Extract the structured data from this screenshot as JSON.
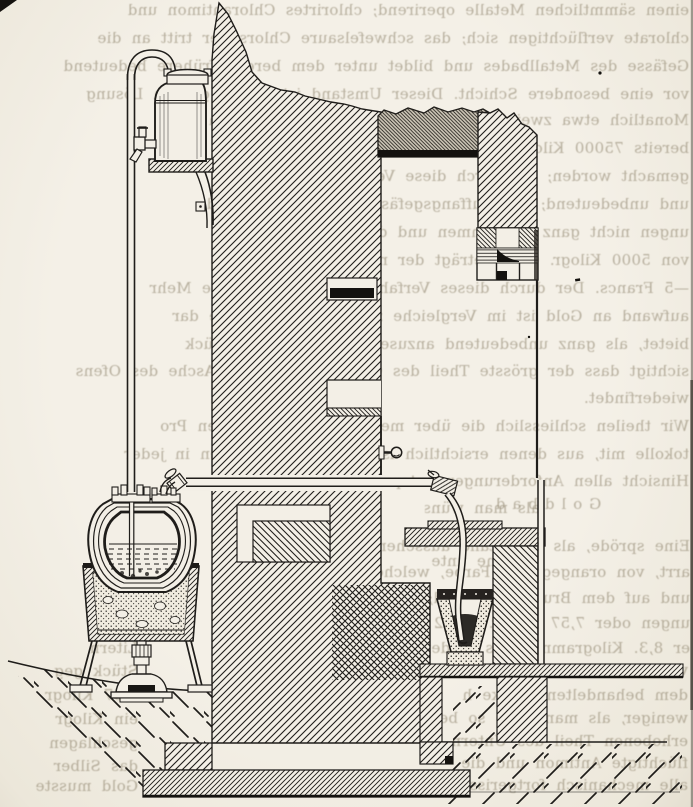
{
  "page": {
    "paper_color": "#f3efe6",
    "ink_color": "#1f1d1a",
    "ghost_ink_color": "#867b64",
    "lintel_gray": "#ccc5b6"
  },
  "ghost_text": {
    "lines": [
      {
        "text": "einen sämmtlichen Metalle operirend; chlorirtes Chlorantimon und",
        "x": 5,
        "y": 2,
        "w": 684
      },
      {
        "text": "chlorate verflüchtigen sich; das schwefelsaure Chlorsilber tritt an die",
        "x": 5,
        "y": 30,
        "w": 684
      },
      {
        "text": "Gefässe des Metallbades und bildet unter dem bereits frühere bedeutend",
        "x": 5,
        "y": 58,
        "w": 684
      },
      {
        "text": "vor eine besondere Schicht. Dieser Umstand ist in der ganzen Lösung",
        "x": 5,
        "y": 86,
        "w": 684
      },
      {
        "text": "Monatlich etwa zwei Drittel der in den Oefen derselben sind",
        "x": 5,
        "y": 112,
        "w": 684
      },
      {
        "text": "bereits 75000 Kilogr. Gold mit dem Feingehalte lange",
        "x": 5,
        "y": 140,
        "w": 684
      },
      {
        "text": "gemacht worden; die durch diese Verfahren gegeben",
        "x": 5,
        "y": 168,
        "w": 684
      },
      {
        "text": "und unbedeutend; das Auffangsgefäss des Apparates bed",
        "x": 5,
        "y": 196,
        "w": 684
      },
      {
        "text": "ungen nicht ganz vollkommen und die zur Reinigung",
        "x": 5,
        "y": 224,
        "w": 684
      },
      {
        "text": "von 5000 Kilogr. Gold beträgt der nicht mehr als",
        "x": 5,
        "y": 252,
        "w": 684
      },
      {
        "text": "—5 Francs. Der durch dieses Verfahren bedingte geringe Mehr",
        "x": 5,
        "y": 280,
        "w": 684
      },
      {
        "text": "aufwand an Gold ist im Vergleiche zu dem die derselbe dar",
        "x": 5,
        "y": 308,
        "w": 684
      },
      {
        "text": "bietet, als ganz unbedeutend anzusehen, wenn man berück",
        "x": 5,
        "y": 336,
        "w": 684
      },
      {
        "text": "sichtigt dass der grösste Theil des Goldes sich in der Asche des Ofens",
        "x": 5,
        "y": 363,
        "w": 684
      },
      {
        "text": "wiederfindet.",
        "x": 5,
        "y": 390,
        "w": 684
      },
      {
        "text": "Wir theilen schliesslich die über mehrere Jahre geführten Pro",
        "x": 5,
        "y": 418,
        "w": 684
      },
      {
        "text": "tokolle mit, aus denen ersichtlich ist, dass das Verfahren in jeder",
        "x": 5,
        "y": 446,
        "w": 684
      },
      {
        "text": "Hinsicht allen Anforderungen entspricht.",
        "x": 5,
        "y": 473,
        "w": 684
      },
      {
        "text": "Goldbad",
        "x": 400,
        "y": 496,
        "w": 290,
        "cls": "spaced"
      },
      {
        "text": "als man wünsch",
        "x": 425,
        "y": 500,
        "w": 115
      },
      {
        "text": "Eine spröde, als Rückstand aussehende",
        "x": 340,
        "y": 538,
        "w": 350
      },
      {
        "text": "welche unter",
        "x": 432,
        "y": 553,
        "w": 100
      },
      {
        "text": "arrt, von orangegelber Farbe, welche unter",
        "x": 340,
        "y": 564,
        "w": 350
      },
      {
        "text": "und auf dem Bruche glänzend; nach",
        "x": 340,
        "y": 590,
        "w": 350
      },
      {
        "text": "ungen oder 7,57 Kilogr. auf 2",
        "x": 340,
        "y": 615,
        "w": 350
      },
      {
        "text": "er 8,3. Kilogramm eines Sieden",
        "x": 340,
        "y": 640,
        "w": 350
      },
      {
        "text": "von den Arbeitern wie die",
        "x": 420,
        "y": 662,
        "w": 268
      },
      {
        "text": "dem behandelten Stücke h",
        "x": 420,
        "y": 687,
        "w": 268
      },
      {
        "text": "weniger, als man dem; so bei",
        "x": 420,
        "y": 710,
        "w": 268
      },
      {
        "text": "erhobenen Theil des Untern",
        "x": 420,
        "y": 733,
        "w": 268
      },
      {
        "text": "flüchtigte Antimon und die",
        "x": 420,
        "y": 755,
        "w": 268
      },
      {
        "text": "alle mechanisch fortgerissenen",
        "x": 420,
        "y": 777,
        "w": 268
      },
      {
        "text": "Litern",
        "x": 42,
        "y": 640,
        "w": 96
      },
      {
        "text": "Stück geg",
        "x": 42,
        "y": 663,
        "w": 96
      },
      {
        "text": "7,57 Kilogr",
        "x": 42,
        "y": 687,
        "w": 96
      },
      {
        "text": "ein Kilogr",
        "x": 42,
        "y": 711,
        "w": 96
      },
      {
        "text": "geschlagen",
        "x": 42,
        "y": 735,
        "w": 96
      },
      {
        "text": "das Silber",
        "x": 42,
        "y": 758,
        "w": 96
      },
      {
        "text": "Gold musste",
        "x": 36,
        "y": 778,
        "w": 102
      }
    ]
  }
}
